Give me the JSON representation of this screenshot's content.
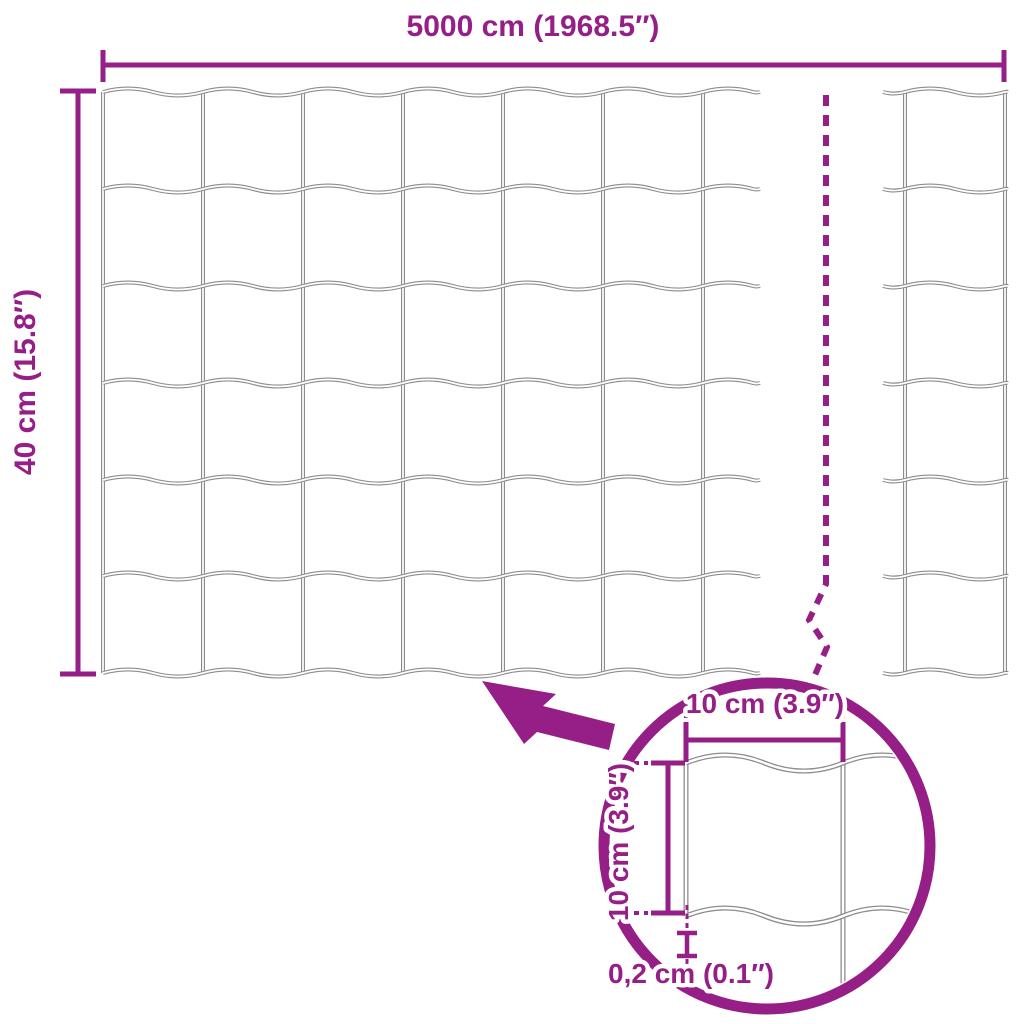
{
  "diagram": {
    "subject": "wire-mesh-fence-roll",
    "kind": "product-dimension-diagram"
  },
  "dimensions": {
    "total_width": "5000 cm (1968.5″)",
    "total_height": "40 cm (15.8″)",
    "mesh_opening_width": "10 cm (3.9″)",
    "mesh_opening_height": "10 cm (3.9″)",
    "wire_thickness": "0,2 cm (0.1″)"
  },
  "mesh": {
    "visible_columns": 6,
    "visible_rows": 6,
    "sections": 2,
    "has_break_line": true
  },
  "colors": {
    "accent": "#951e87",
    "wire": "#8c8c8c",
    "background": "#ffffff"
  }
}
